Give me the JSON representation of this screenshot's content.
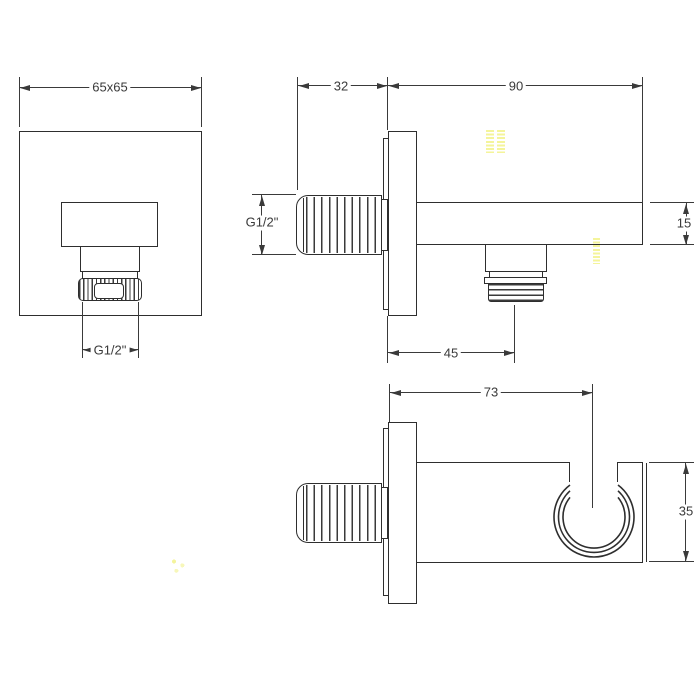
{
  "drawing": {
    "front_view": {
      "plate_size": "65x65",
      "outlet_thread": "G1/2\""
    },
    "side_view": {
      "wall_plate_depth": "32",
      "total_length": "90",
      "arm_height": "15",
      "outlet_offset": "45",
      "inlet_thread": "G1/2\""
    },
    "bottom_view": {
      "holder_center_offset": "73",
      "body_width": "35"
    }
  },
  "colors": {
    "line": "#2e2e2e",
    "dimension_line": "#3a3a3a",
    "background": "#ffffff",
    "watermark_artifact": "#f2f282"
  }
}
